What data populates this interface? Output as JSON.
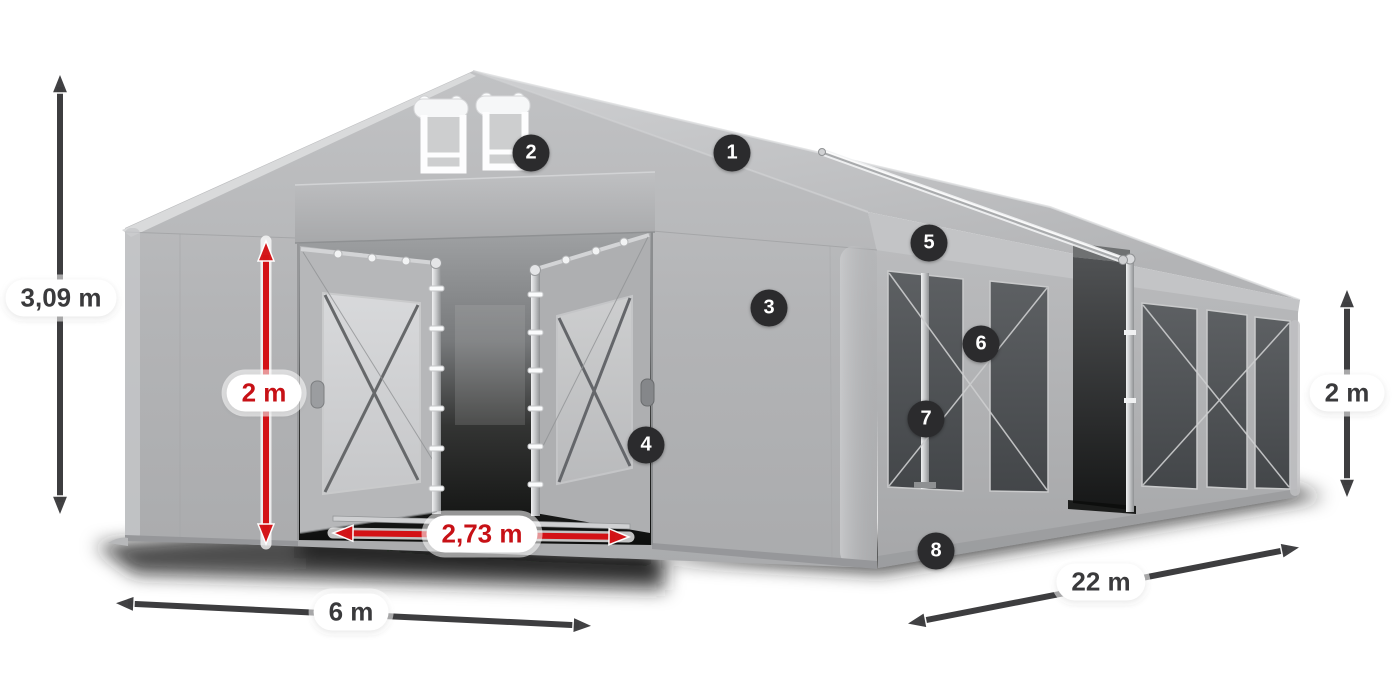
{
  "diagram": {
    "alt": "Gray marquee party tent shown in perspective with open front doors, two roof vents, mesh side windows and one open side section",
    "background": "#ffffff"
  },
  "colors": {
    "dark": "#3d3d3f",
    "red": "#d31216",
    "pill_bg": "#ffffff",
    "badge_bg": "#2b2b2d",
    "badge_text": "#ffffff"
  },
  "dimensions": [
    {
      "id": "total-height",
      "label": "3,09 m",
      "color": "dark",
      "arrow": {
        "x1": 60,
        "y1": 73,
        "x2": 60,
        "y2": 516
      },
      "label_pos": {
        "x": 61,
        "y": 298
      }
    },
    {
      "id": "door-height",
      "label": "2 m",
      "color": "red",
      "arrow": {
        "x1": 266,
        "y1": 241,
        "x2": 266,
        "y2": 544
      },
      "label_pos": {
        "x": 264,
        "y": 393
      }
    },
    {
      "id": "door-width",
      "label": "2,73 m",
      "color": "red",
      "arrow": {
        "x1": 333,
        "y1": 533,
        "x2": 629,
        "y2": 537
      },
      "label_pos": {
        "x": 482,
        "y": 534
      }
    },
    {
      "id": "front-width",
      "label": "6 m",
      "color": "dark",
      "arrow": {
        "x1": 114,
        "y1": 603,
        "x2": 593,
        "y2": 626
      },
      "label_pos": {
        "x": 351,
        "y": 612
      }
    },
    {
      "id": "length",
      "label": "22 m",
      "color": "dark",
      "arrow": {
        "x1": 906,
        "y1": 624,
        "x2": 1301,
        "y2": 547
      },
      "label_pos": {
        "x": 1101,
        "y": 582
      }
    },
    {
      "id": "side-height",
      "label": "2 m",
      "color": "dark",
      "arrow": {
        "x1": 1347,
        "y1": 288,
        "x2": 1347,
        "y2": 499
      },
      "label_pos": {
        "x": 1347,
        "y": 393
      }
    }
  ],
  "markers": [
    {
      "number": "1",
      "x": 732,
      "y": 153
    },
    {
      "number": "2",
      "x": 531,
      "y": 153
    },
    {
      "number": "3",
      "x": 769,
      "y": 308
    },
    {
      "number": "4",
      "x": 646,
      "y": 445
    },
    {
      "number": "5",
      "x": 929,
      "y": 243
    },
    {
      "number": "6",
      "x": 981,
      "y": 344
    },
    {
      "number": "7",
      "x": 926,
      "y": 419
    },
    {
      "number": "8",
      "x": 936,
      "y": 551
    }
  ]
}
